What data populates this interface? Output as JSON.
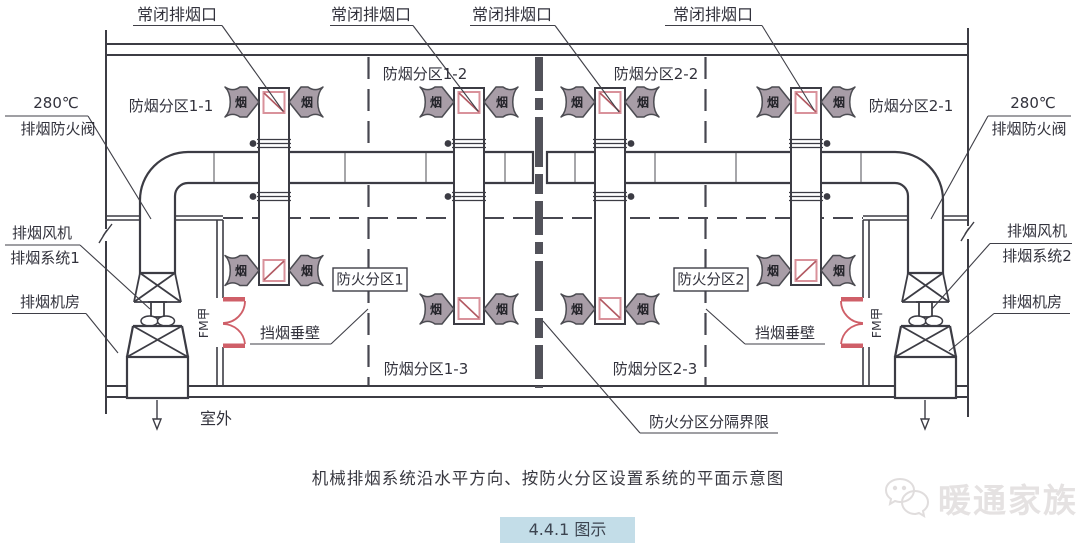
{
  "title": "机械排烟系统沿水平方向、按防火分区设置系统的平面示意图",
  "caption": "4.4.1 图示",
  "watermark": "暖通家族",
  "labels": {
    "closed_smoke_vent": "常闭排烟口",
    "temp": "280℃",
    "smoke_fire_damper": "排烟防火阀",
    "smoke_fan": "排烟风机",
    "smoke_system_1": "排烟系统1",
    "smoke_system_2": "排烟系统2",
    "smoke_fan_room": "排烟机房",
    "smoke_barrier": "挡烟垂壁",
    "fire_compartment_1": "防火分区1",
    "fire_compartment_2": "防火分区2",
    "fire_compartment_boundary": "防火分区分隔界限",
    "outdoor": "室外",
    "fire_door": "FM甲",
    "smoke": "烟"
  },
  "zones": {
    "z1_1": "防烟分区1-1",
    "z1_2": "防烟分区1-2",
    "z1_3": "防烟分区1-3",
    "z2_1": "防烟分区2-1",
    "z2_2": "防烟分区2-2",
    "z2_3": "防烟分区2-3"
  },
  "colors": {
    "line": "#3c3c44",
    "text": "#32323c",
    "damper_outline": "#d9929b",
    "damper_diagonal": "#b25962",
    "door_red": "#cf5f68",
    "smoke_arrow_fill": "#a89da7",
    "caption_bg": "#c3dde8",
    "watermark_gray": "#e5e2e2"
  }
}
